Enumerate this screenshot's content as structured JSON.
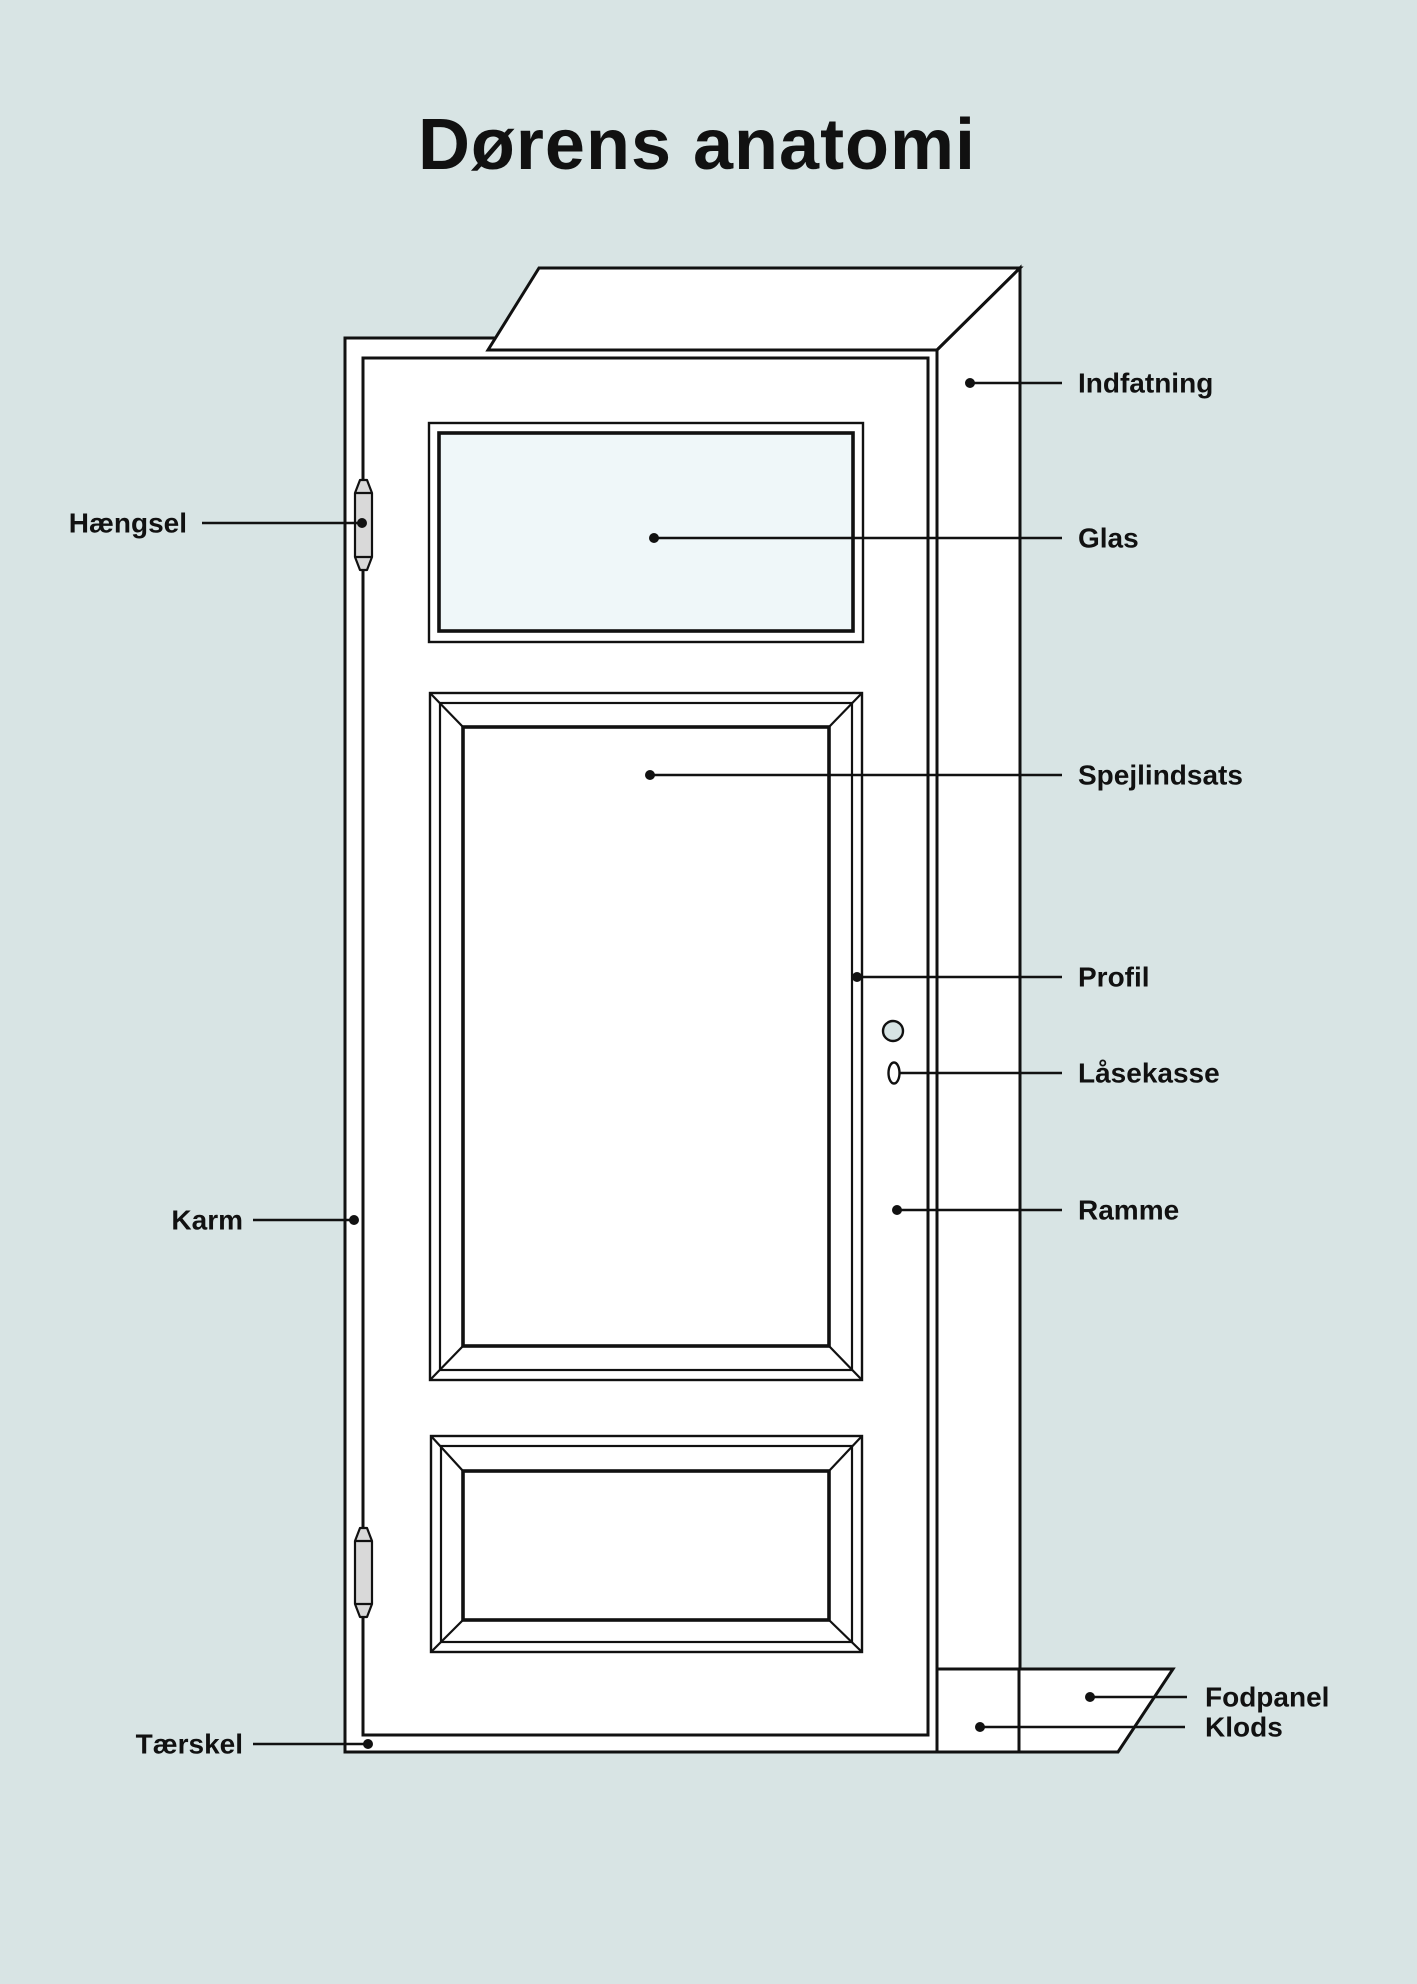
{
  "title": "Dørens anatomi",
  "labels": {
    "indfatning": "Indfatning",
    "glas": "Glas",
    "spejlindsats": "Spejlindsats",
    "profil": "Profil",
    "lasekasse": "Låsekasse",
    "ramme": "Ramme",
    "fodpanel": "Fodpanel",
    "klods": "Klods",
    "haengsel": "Hængsel",
    "karm": "Karm",
    "taerskel": "Tærskel"
  },
  "colors": {
    "background": "#d8e4e4",
    "door": "#ffffff",
    "glass": "#eff7f9",
    "line": "#111111",
    "hinge_fill": "#d9d9d9",
    "knob_fill": "#d7e4e4",
    "text": "#111111"
  }
}
